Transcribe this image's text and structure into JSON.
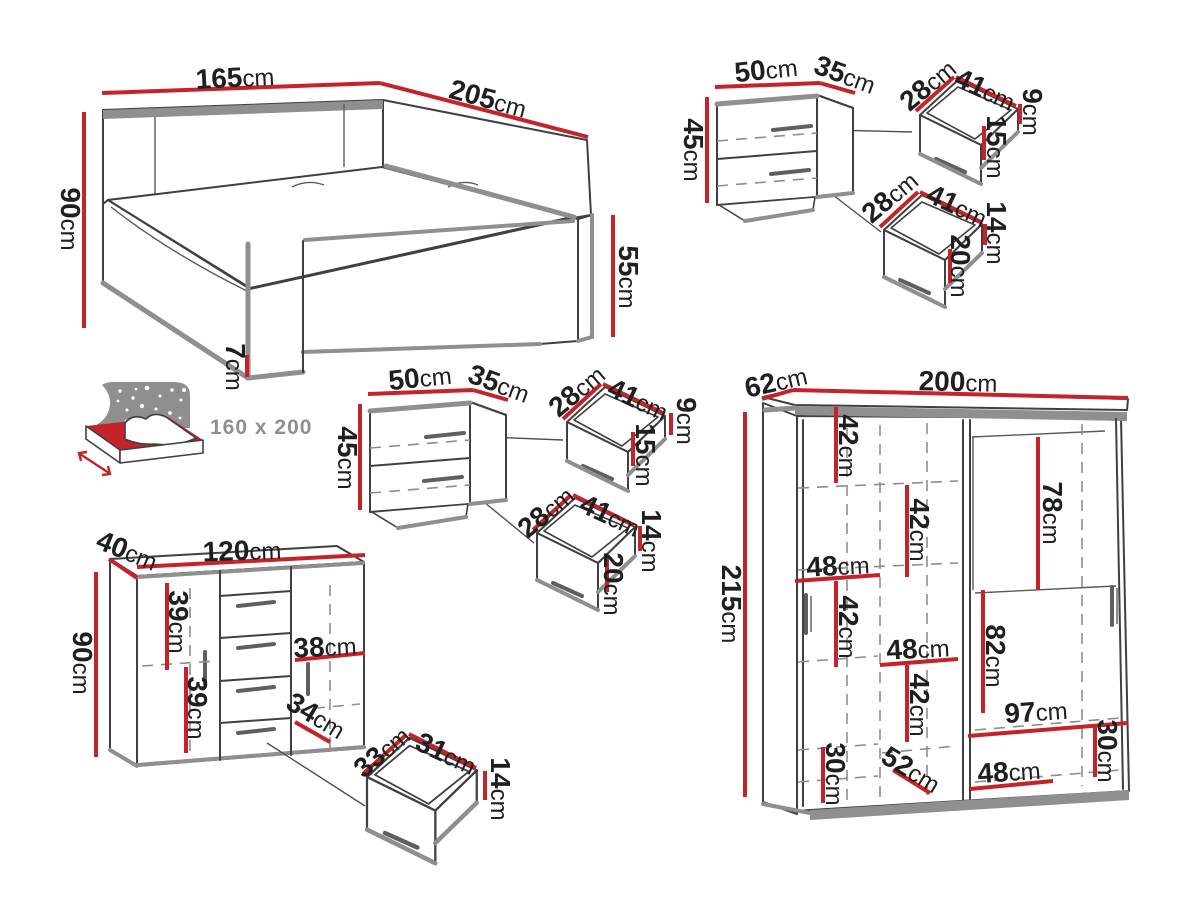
{
  "colors": {
    "accent": "#c5232a",
    "outline": "#404040",
    "grey": "#8f8f8f",
    "text": "#1f1f1f",
    "muted": "#8f8f8f",
    "background": "#ffffff"
  },
  "bed": {
    "width": {
      "v": "165",
      "u": "cm"
    },
    "length": {
      "v": "205",
      "u": "cm"
    },
    "headboard_height": {
      "v": "90",
      "u": "cm"
    },
    "foot_height": {
      "v": "55",
      "u": "cm"
    },
    "leg_height": {
      "v": "7",
      "u": "cm"
    },
    "mattress_size": "160 x 200"
  },
  "nightstand": {
    "width": {
      "v": "50",
      "u": "cm"
    },
    "depth": {
      "v": "35",
      "u": "cm"
    },
    "height": {
      "v": "45",
      "u": "cm"
    },
    "top_drawer": {
      "depth": {
        "v": "28",
        "u": "cm"
      },
      "width": {
        "v": "41",
        "u": "cm"
      },
      "back_height": {
        "v": "9",
        "u": "cm"
      },
      "front_height": {
        "v": "15",
        "u": "cm"
      }
    },
    "bottom_drawer": {
      "depth": {
        "v": "28",
        "u": "cm"
      },
      "width": {
        "v": "41",
        "u": "cm"
      },
      "back_height": {
        "v": "14",
        "u": "cm"
      },
      "front_height": {
        "v": "20",
        "u": "cm"
      }
    }
  },
  "dresser": {
    "depth": {
      "v": "40",
      "u": "cm"
    },
    "width": {
      "v": "120",
      "u": "cm"
    },
    "height": {
      "v": "90",
      "u": "cm"
    },
    "upper_section": {
      "v": "39",
      "u": "cm"
    },
    "lower_section": {
      "v": "39",
      "u": "cm"
    },
    "shelf_width": {
      "v": "38",
      "u": "cm"
    },
    "drawer_front": {
      "v": "34",
      "u": "cm"
    },
    "drawer": {
      "depth": {
        "v": "33",
        "u": "cm"
      },
      "width": {
        "v": "31",
        "u": "cm"
      },
      "height": {
        "v": "14",
        "u": "cm"
      }
    }
  },
  "wardrobe": {
    "depth": {
      "v": "62",
      "u": "cm"
    },
    "width": {
      "v": "200",
      "u": "cm"
    },
    "height": {
      "v": "215",
      "u": "cm"
    },
    "sec_left_top": {
      "v": "42",
      "u": "cm"
    },
    "sec_mid_top": {
      "v": "42",
      "u": "cm"
    },
    "hang_top": {
      "v": "78",
      "u": "cm"
    },
    "left_width": {
      "v": "48",
      "u": "cm"
    },
    "sec_left_mid": {
      "v": "42",
      "u": "cm"
    },
    "mid_width": {
      "v": "48",
      "u": "cm"
    },
    "sec_mid_low": {
      "v": "42",
      "u": "cm"
    },
    "hang_bottom": {
      "v": "82",
      "u": "cm"
    },
    "bottom_width": {
      "v": "97",
      "u": "cm"
    },
    "bottom_right_h": {
      "v": "30",
      "u": "cm"
    },
    "bottom_inner_width": {
      "v": "48",
      "u": "cm"
    },
    "bottom_diag": {
      "v": "52",
      "u": "cm"
    },
    "bottom_left_h": {
      "v": "30",
      "u": "cm"
    }
  }
}
